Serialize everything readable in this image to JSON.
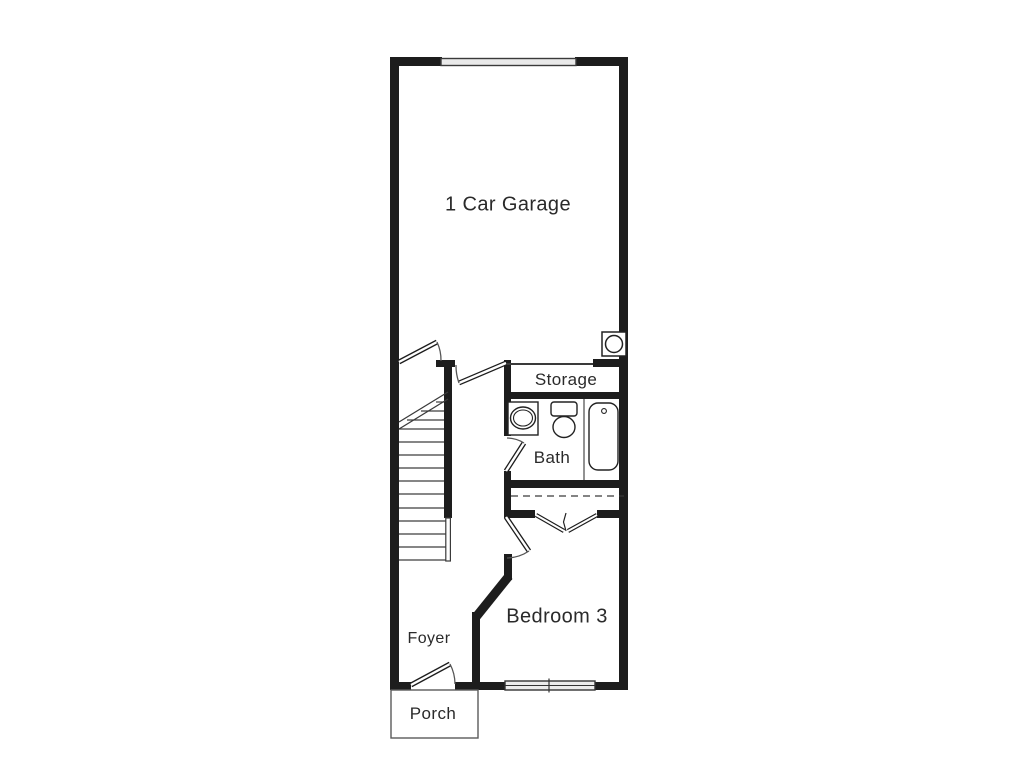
{
  "floorplan": {
    "title": "Townhome first floor plan",
    "rooms": [
      {
        "name": "garage",
        "label": "1 Car Garage"
      },
      {
        "name": "storage",
        "label": "Storage"
      },
      {
        "name": "bath",
        "label": "Bath"
      },
      {
        "name": "bedroom",
        "label": "Bedroom 3"
      },
      {
        "name": "foyer",
        "label": "Foyer"
      },
      {
        "name": "porch",
        "label": "Porch"
      }
    ],
    "fixtures": [
      "garage-door",
      "water-heater",
      "staircase",
      "stair-break-line",
      "sink",
      "toilet",
      "bathtub",
      "closet-rod-dashed-line",
      "bifold-closet-doors",
      "bedroom-window",
      "entry-door",
      "garage-stair-door",
      "garage-hall-door",
      "bath-door",
      "bedroom-door"
    ],
    "colors": {
      "wall": "#1d1d1d",
      "line": "#3a3a3a",
      "light_fill": "#e9e9e9",
      "background": "#ffffff",
      "text": "#2a2a2a"
    }
  }
}
